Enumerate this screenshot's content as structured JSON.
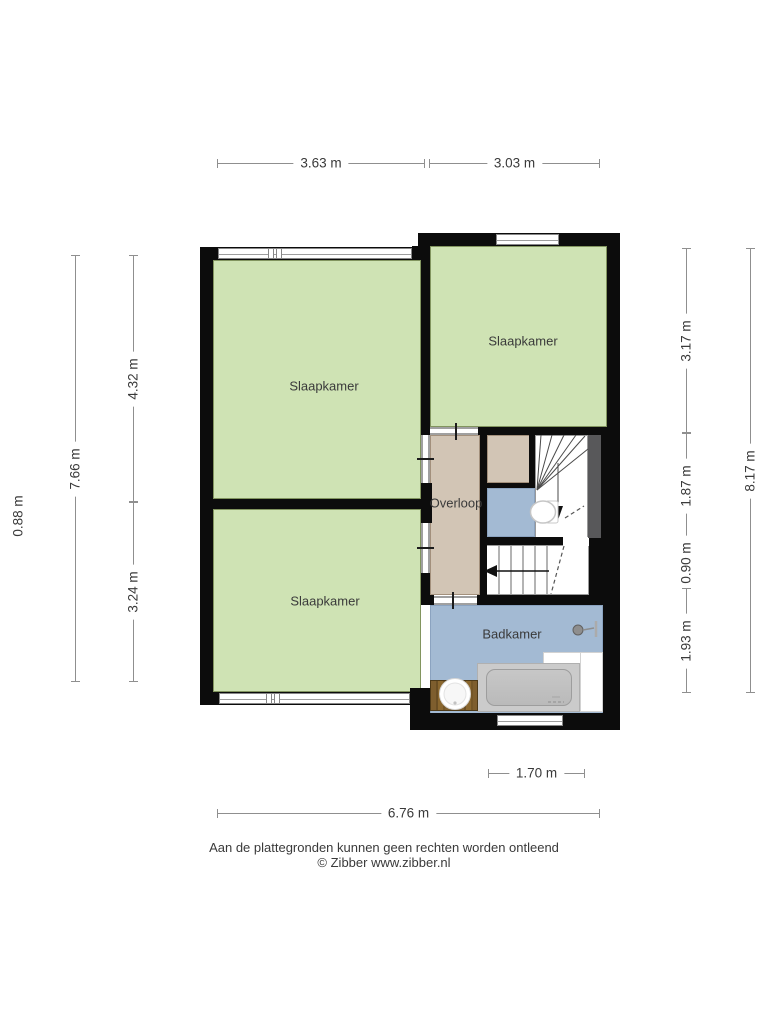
{
  "plan": {
    "rooms": {
      "bedroom_top_left": {
        "label": "Slaapkamer"
      },
      "bedroom_top_right": {
        "label": "Slaapkamer"
      },
      "bedroom_bottom_left": {
        "label": "Slaapkamer"
      },
      "landing": {
        "label": "Overloop"
      },
      "bathroom": {
        "label": "Badkamer"
      }
    },
    "dimensions": {
      "top_left_width": "3.63 m",
      "top_right_width": "3.03 m",
      "bottom_bathroom_width": "1.70 m",
      "bottom_total_width": "6.76 m",
      "left_upper_height": "4.32 m",
      "left_lower_height": "3.24 m",
      "left_total_height": "7.66 m",
      "left_offset": "0.88 m",
      "right_bedroom_height": "3.17 m",
      "right_stairs_height": "1.87 m",
      "right_landing_height": "0.90 m",
      "right_bathroom_height": "1.93 m",
      "right_total_height": "8.17 m"
    }
  },
  "footer": {
    "disclaimer": "Aan de plattegronden kunnen geen rechten worden ontleend",
    "copyright": "© Zibber www.zibber.nl"
  },
  "colors": {
    "room-green": "#cfe3b4",
    "room-beige": "#d2c5b5",
    "room-blue": "#a3bad3",
    "wall-black": "#0c0c0c",
    "accent-gray": "#58585a",
    "wood-brown": "#7c5c2c",
    "dim-line": "#8f8f8f",
    "text": "#3a3a3a"
  }
}
